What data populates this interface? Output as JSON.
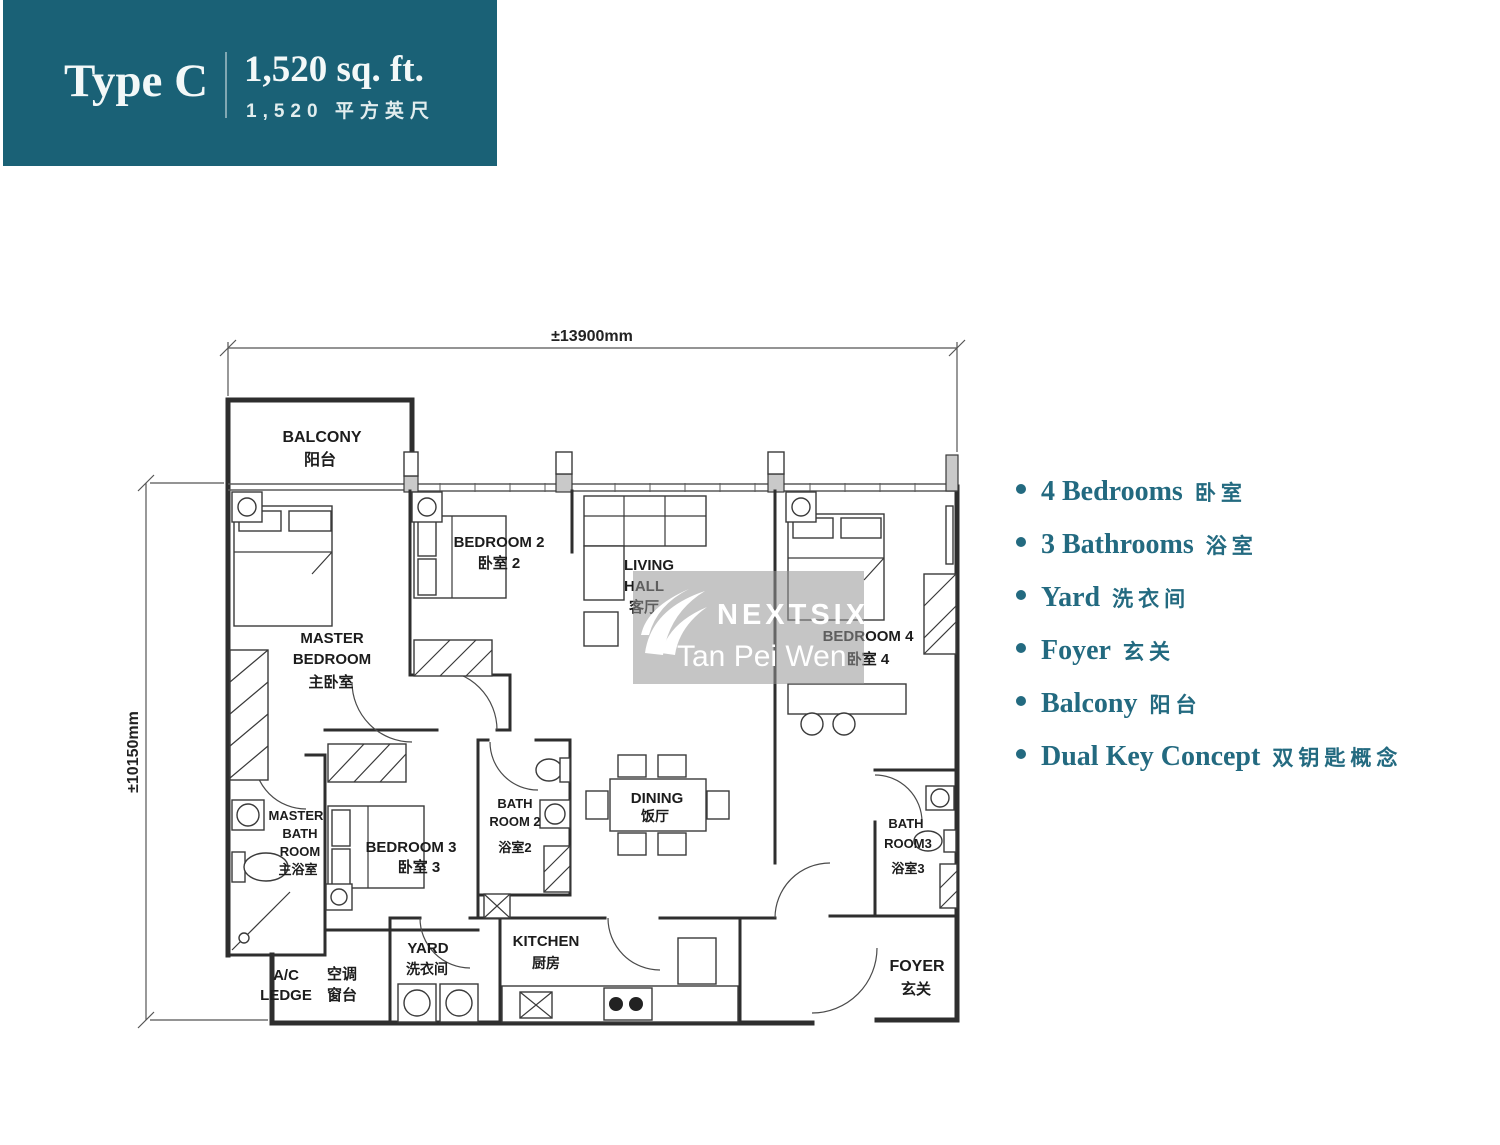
{
  "header": {
    "type_label": "Type C",
    "area_en": "1,520 sq. ft.",
    "area_zh": "1,520 平方英尺"
  },
  "dimensions": {
    "width_label": "±13900mm",
    "height_label": "±10150mm"
  },
  "features": {
    "items": [
      {
        "en": "4 Bedrooms",
        "zh": "卧室"
      },
      {
        "en": "3 Bathrooms",
        "zh": "浴室"
      },
      {
        "en": "Yard",
        "zh": "洗衣间"
      },
      {
        "en": "Foyer",
        "zh": "玄关"
      },
      {
        "en": "Balcony",
        "zh": "阳台"
      },
      {
        "en": "Dual Key Concept",
        "zh": "双钥匙概念"
      }
    ]
  },
  "watermark": {
    "brand": "NEXTSIX",
    "agent": "Tan Pei Wen"
  },
  "rooms": {
    "balcony": {
      "en": "BALCONY",
      "zh": "阳台"
    },
    "master_bedroom": {
      "en1": "MASTER",
      "en2": "BEDROOM",
      "zh": "主卧室"
    },
    "bedroom2": {
      "en": "BEDROOM 2",
      "zh": "卧室 2"
    },
    "living": {
      "en1": "LIVING",
      "en2": "HALL",
      "zh": "客厅"
    },
    "bedroom4": {
      "en": "BEDROOM 4",
      "zh": "卧室 4"
    },
    "master_bath": {
      "en1": "MASTER",
      "en2": "BATH",
      "en3": "ROOM",
      "zh": "主浴室"
    },
    "bedroom3": {
      "en": "BEDROOM 3",
      "zh": "卧室 3"
    },
    "bathroom2": {
      "en1": "BATH",
      "en2": "ROOM 2",
      "zh": "浴室2"
    },
    "dining": {
      "en": "DINING",
      "zh": "饭厅"
    },
    "bathroom3": {
      "en1": "BATH",
      "en2": "ROOM3",
      "zh": "浴室3"
    },
    "ac_ledge": {
      "en1": "A/C",
      "en2": "LEDGE",
      "zh1": "空调",
      "zh2": "窗台"
    },
    "yard": {
      "en": "YARD",
      "zh": "洗衣间"
    },
    "kitchen": {
      "en": "KITCHEN",
      "zh": "厨房"
    },
    "foyer": {
      "en": "FOYER",
      "zh": "玄关"
    }
  },
  "colors": {
    "header_teal": "#1A6176",
    "feature_teal": "#236A80",
    "wall": "#2e2e2e",
    "watermark_gray": "#999999"
  }
}
